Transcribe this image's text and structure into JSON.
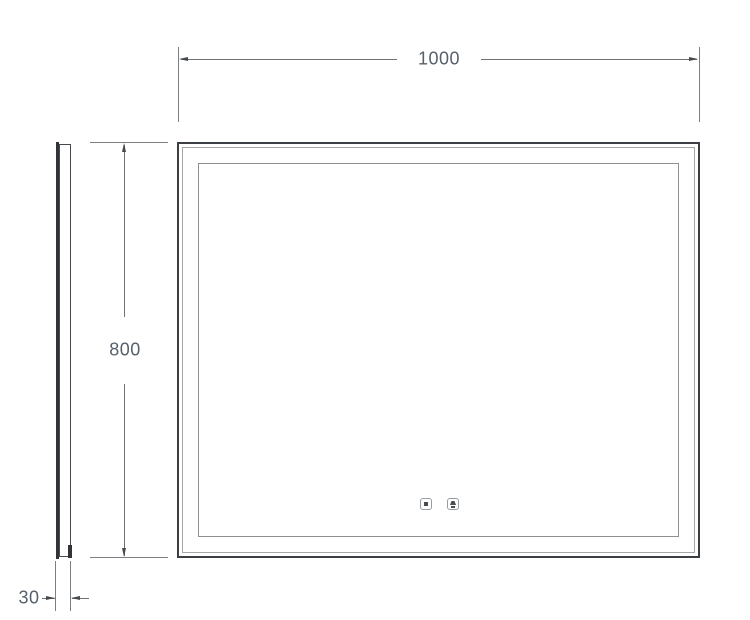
{
  "drawing": {
    "dimensions": {
      "width": {
        "label": "1000"
      },
      "height": {
        "label": "800"
      },
      "depth": {
        "label": "30"
      }
    },
    "icons": [
      {
        "name": "touch-light-button-icon"
      },
      {
        "name": "touch-defog-button-icon"
      }
    ],
    "colors": {
      "background": "#ffffff",
      "frame_outline": "#3b3e42",
      "frame_mid_outline": "#a6a6a6",
      "led_outline": "#8d8f92",
      "dimension_line": "#6e7175",
      "arrowhead": "#46494d",
      "dimension_text": "#56616b"
    }
  }
}
